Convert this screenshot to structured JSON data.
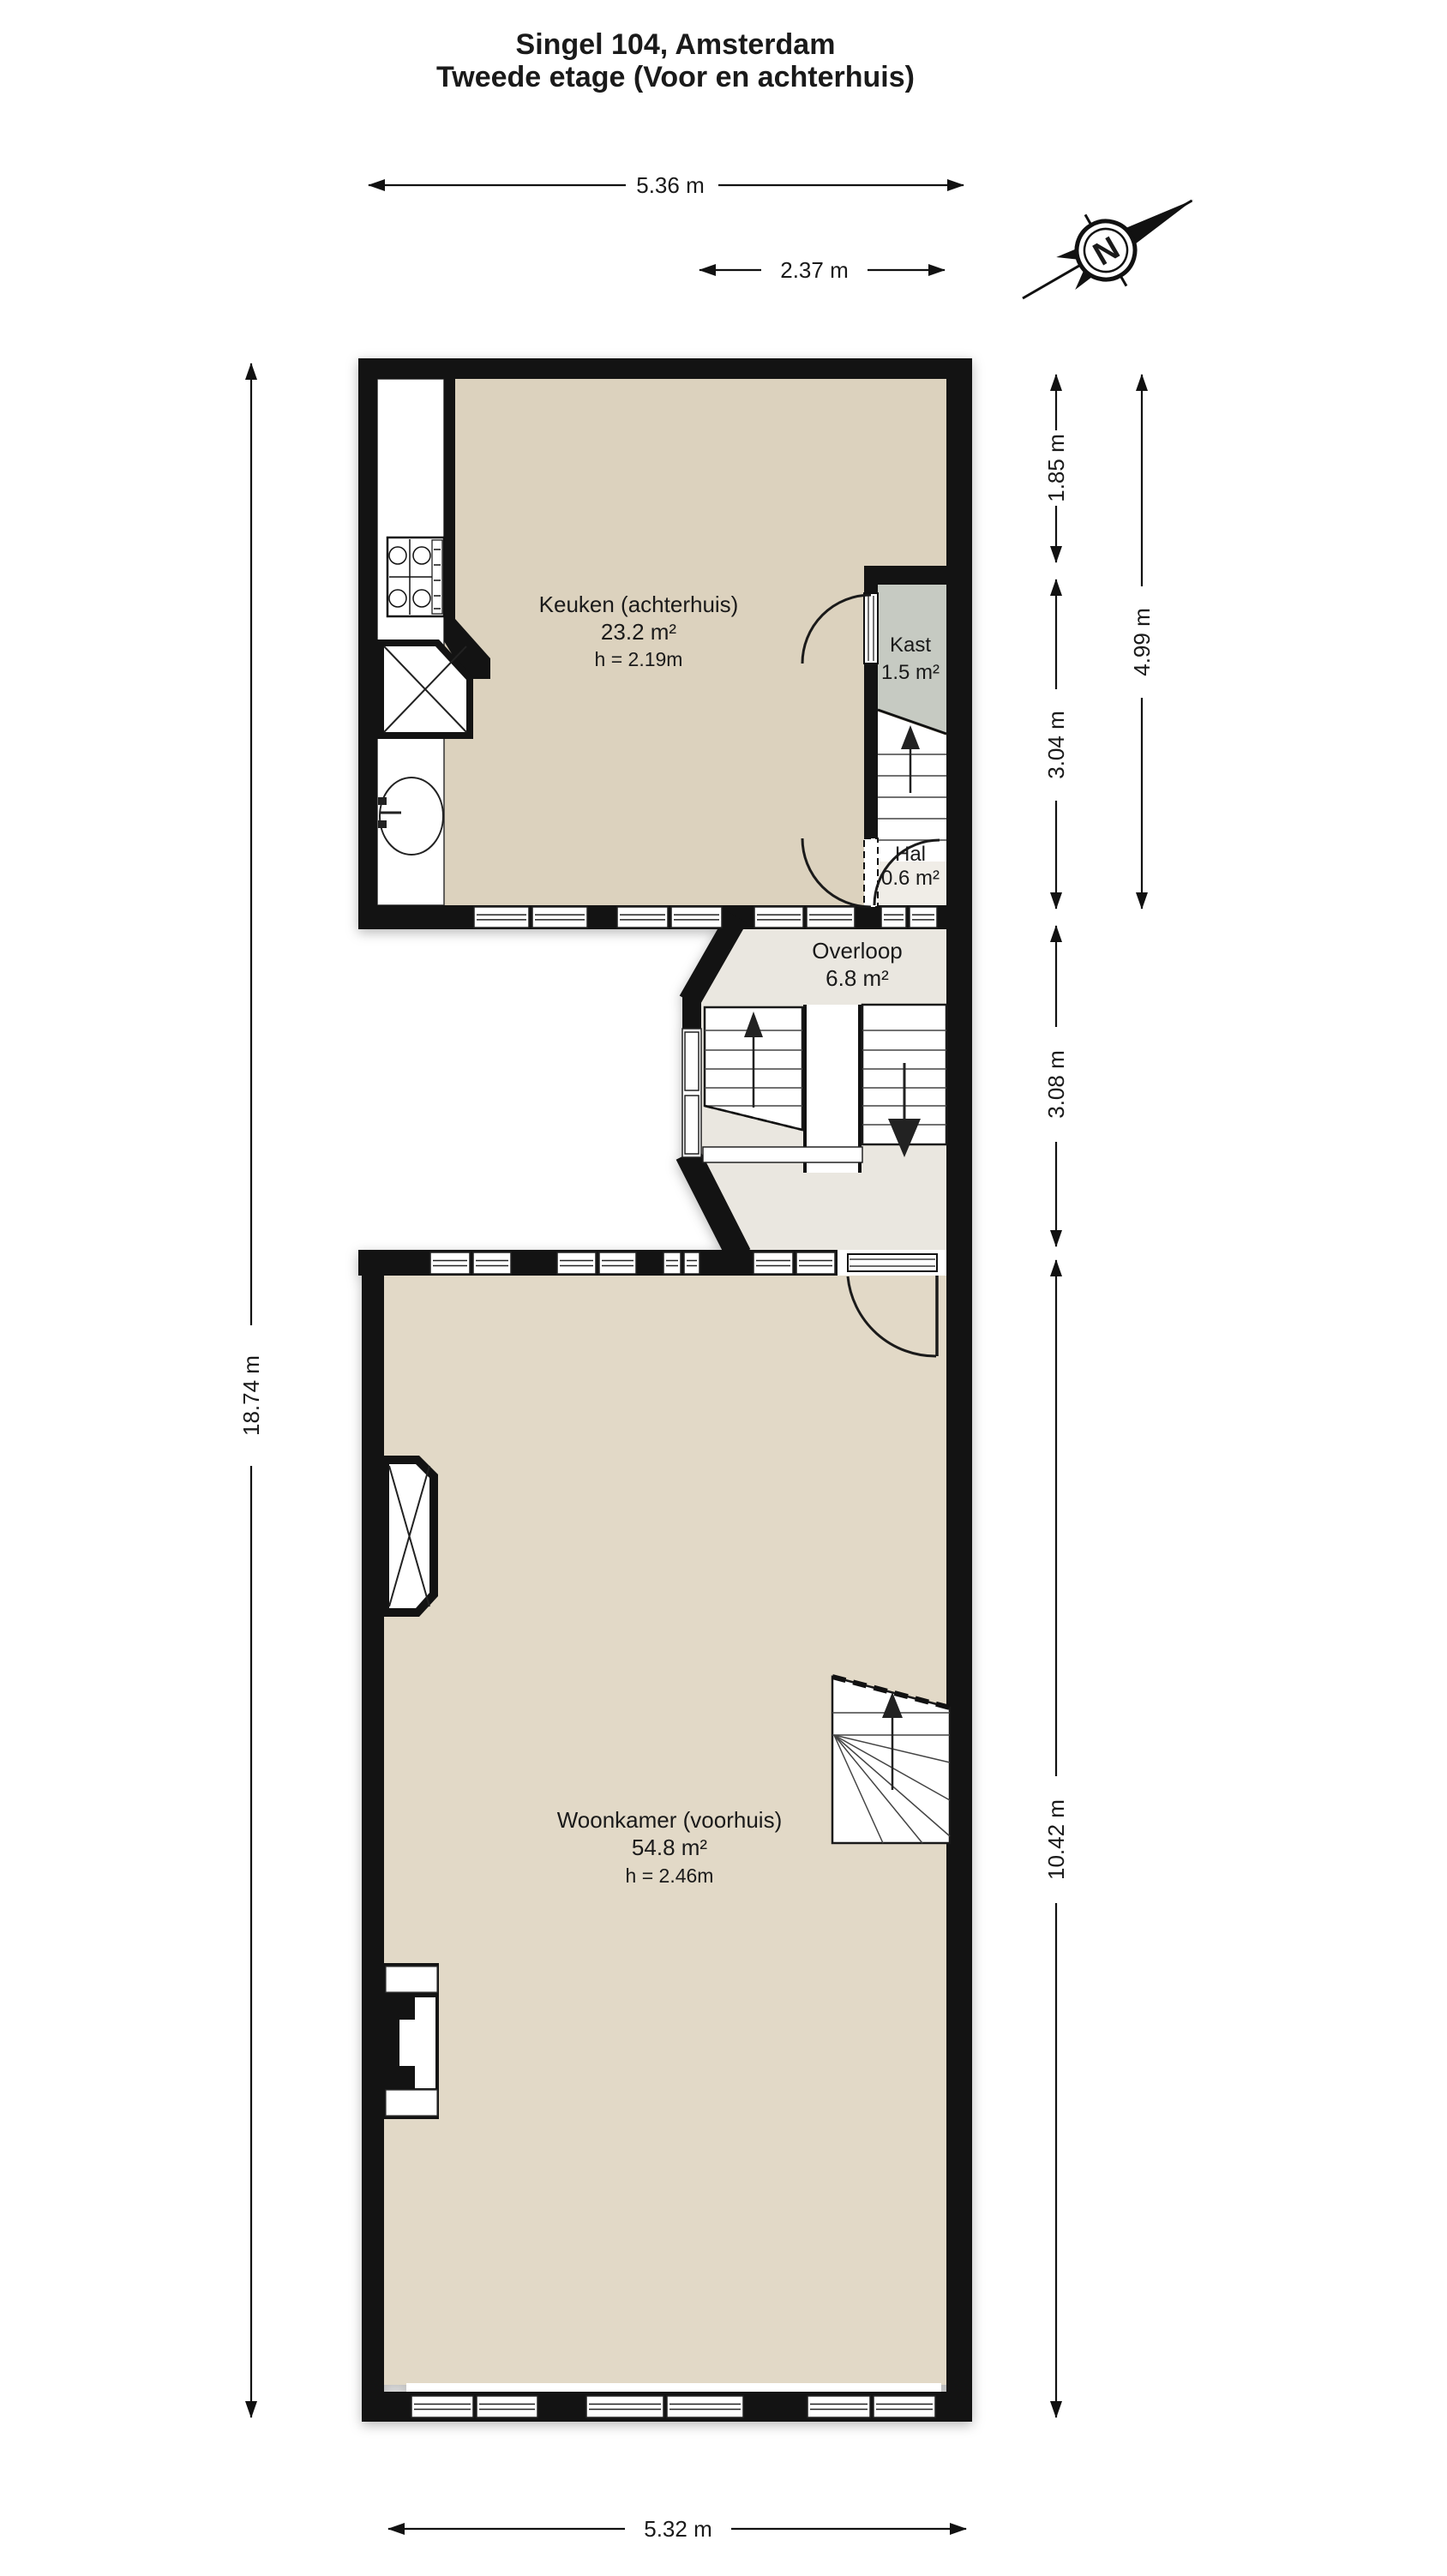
{
  "title": {
    "line1": "Singel 104, Amsterdam",
    "line2": "Tweede etage (Voor en achterhuis)"
  },
  "compass": {
    "north_label": "N"
  },
  "rooms": {
    "keuken": {
      "name": "Keuken (achterhuis)",
      "area": "23.2 m²",
      "ceiling": "h = 2.19m"
    },
    "kast": {
      "name": "Kast",
      "area": "1.5 m²"
    },
    "hal": {
      "name": "Hal",
      "area": "0.6 m²"
    },
    "overloop": {
      "name": "Overloop",
      "area": "6.8 m²"
    },
    "woonkamer": {
      "name": "Woonkamer (voorhuis)",
      "area": "54.8 m²",
      "ceiling": "h = 2.46m"
    }
  },
  "dimensions": {
    "top_width": "5.36 m",
    "overloop_width": "2.37 m",
    "total_height": "18.74 m",
    "kitchen_upper": "1.85 m",
    "kitchen_lower": "3.04 m",
    "kitchen_total": "4.99 m",
    "overloop_height": "3.08 m",
    "woonkamer_height": "10.42 m",
    "bottom_width": "5.32 m"
  },
  "colors": {
    "kitchen_floor": "#DCD2BE",
    "woonkamer_floor": "#E2D9C7",
    "kast_floor": "#C6CAC2",
    "overloop_floor": "#EAE7E0",
    "hal_floor": "#F0EDE7",
    "wall": "#131313"
  }
}
